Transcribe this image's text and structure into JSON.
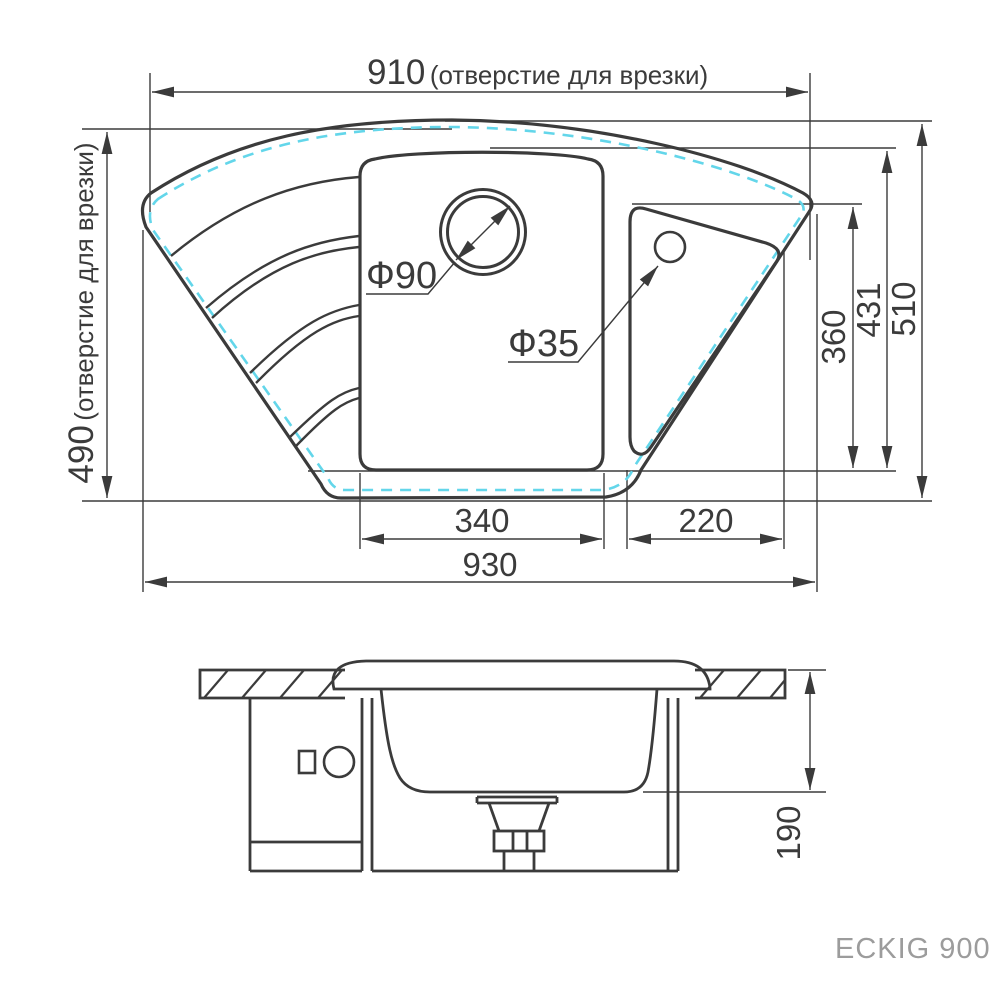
{
  "title": {
    "model": "ECKIG 900"
  },
  "top_view": {
    "width_cutout": {
      "value": "910",
      "note": "(отверстие для врезки)"
    },
    "depth_cutout": {
      "value": "490",
      "note": "(отверстие для врезки)"
    },
    "overall_width": "930",
    "overall_depth": "510",
    "main_bowl_width": "340",
    "main_bowl_depth": "431",
    "side_bowl_width": "220",
    "side_bowl_depth": "360",
    "drain_hole_diameter": "Ф90",
    "tap_hole_diameter": "Ф35"
  },
  "section_view": {
    "bowl_depth": "190"
  },
  "colors": {
    "line": "#3b3b3b",
    "cutout_dash": "#63d6ea",
    "model_label": "#9c9c9c"
  }
}
